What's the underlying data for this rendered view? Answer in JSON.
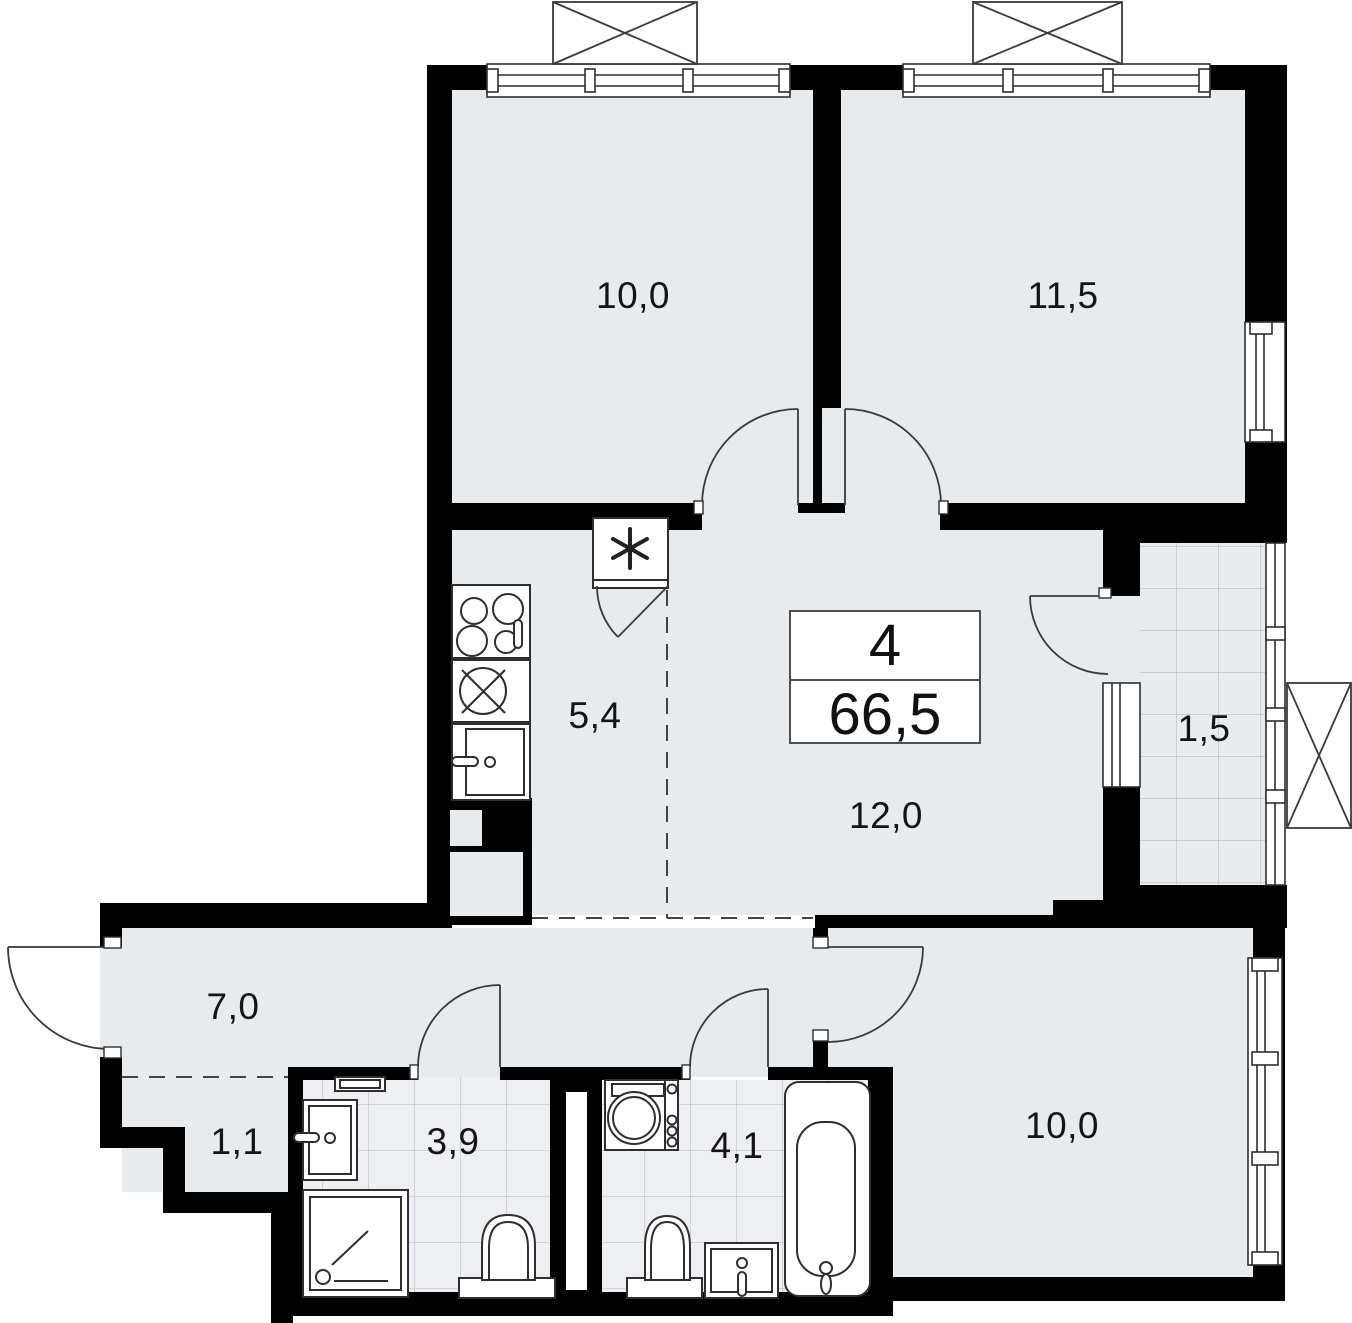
{
  "plan": {
    "summary": {
      "rooms_count": "4",
      "total_area": "66,5"
    },
    "rooms": [
      {
        "key": "bedroom-top-left",
        "area": "10,0"
      },
      {
        "key": "bedroom-top-right",
        "area": "11,5"
      },
      {
        "key": "kitchen",
        "area": "5,4"
      },
      {
        "key": "living-hall",
        "area": "12,0"
      },
      {
        "key": "balcony",
        "area": "1,5"
      },
      {
        "key": "hallway",
        "area": "7,0"
      },
      {
        "key": "closet",
        "area": "1,1"
      },
      {
        "key": "bathroom-left",
        "area": "3,9"
      },
      {
        "key": "bathroom-right",
        "area": "4,1"
      },
      {
        "key": "bedroom-bottom-right",
        "area": "10,0"
      }
    ],
    "fixtures": [
      "stove",
      "oven",
      "kitchen-sink",
      "fridge-snowflake",
      "washing-machine",
      "bathtub",
      "shower",
      "toilet",
      "toilet",
      "washbasin",
      "washbasin",
      "towel-rail"
    ],
    "colors": {
      "wall": "#000000",
      "floor": "#e8ebee",
      "tile_bg": "#edeff2",
      "tile_line": "#bfc4cb",
      "line": "#3a3a3a"
    }
  }
}
